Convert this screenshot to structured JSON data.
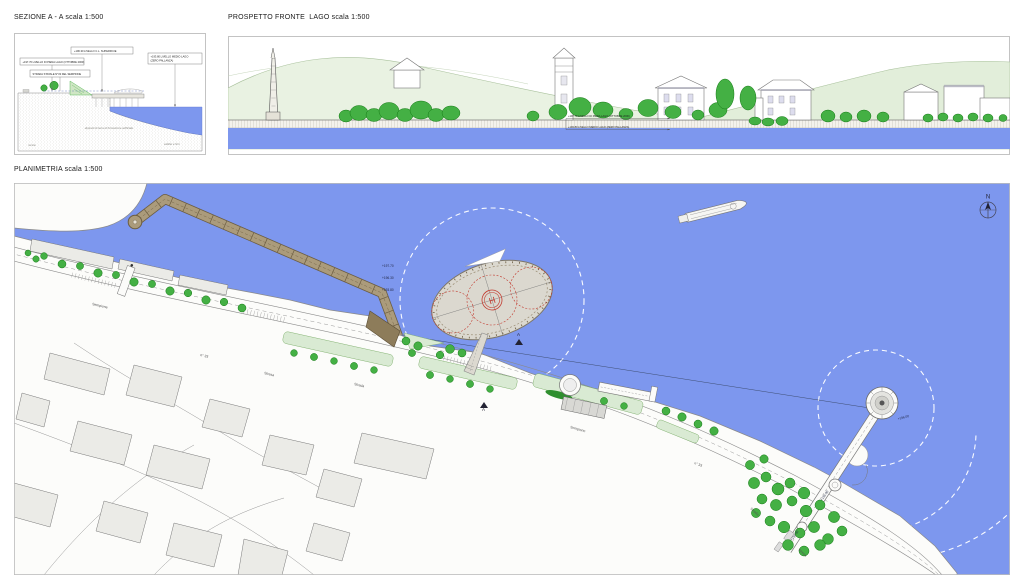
{
  "colors": {
    "water": "#7d97ee",
    "tree": "#44b044",
    "treedark": "#157a15",
    "median": "#d9ead3",
    "hill": "#e9f2e2",
    "breakwater": "#a89878",
    "breakedge": "#6e5f43",
    "helired": "#c23b30",
    "bldg": "#ebebe7"
  },
  "sezione": {
    "title": "SEZIONE A - A scala 1:500",
    "label_surface": "+196.30 LIVELLO C.L. SUPERFICIE",
    "label_flood": "+197.70 LIVELLO DI PIENA LAGO (OTTOBRE 2000)",
    "label_road": "STRADA STATALE N°33 DEL SEMPIONE",
    "label_mean_1": "+193.80 LIVELLO MEDIO LAGO",
    "label_mean_2": "(ZERO PALLANZA)",
    "label_fill": "depositi di terra di formazione artificiale",
    "label_rock": "roccia",
    "label_lakebed": "sabbie e limi"
  },
  "prospetto": {
    "title": "PROSPETTO FRONTE  LAGO scala 1:500",
    "label_flood": "+197.70 LIVELLO DI PIENA LAGO (OTTOBRE 2000)",
    "label_mean": "+193.80 LIVELLO MEDIO LAGO (ZERO PALLANZA)"
  },
  "plan": {
    "title": "PLANIMETRIA scala 1:500",
    "north": "N",
    "helipad": "H",
    "section_a": "A",
    "road_labels": [
      "Sempione",
      "n° 33",
      "Stresa",
      "Strada",
      "Sempione",
      "n° 33",
      "Strada",
      "Stresa"
    ],
    "levels": [
      "+197.70",
      "+196.30",
      "+193.80"
    ],
    "platform_level": "+196.00",
    "pier_levels": [
      "+195.00",
      "+194.50"
    ]
  }
}
